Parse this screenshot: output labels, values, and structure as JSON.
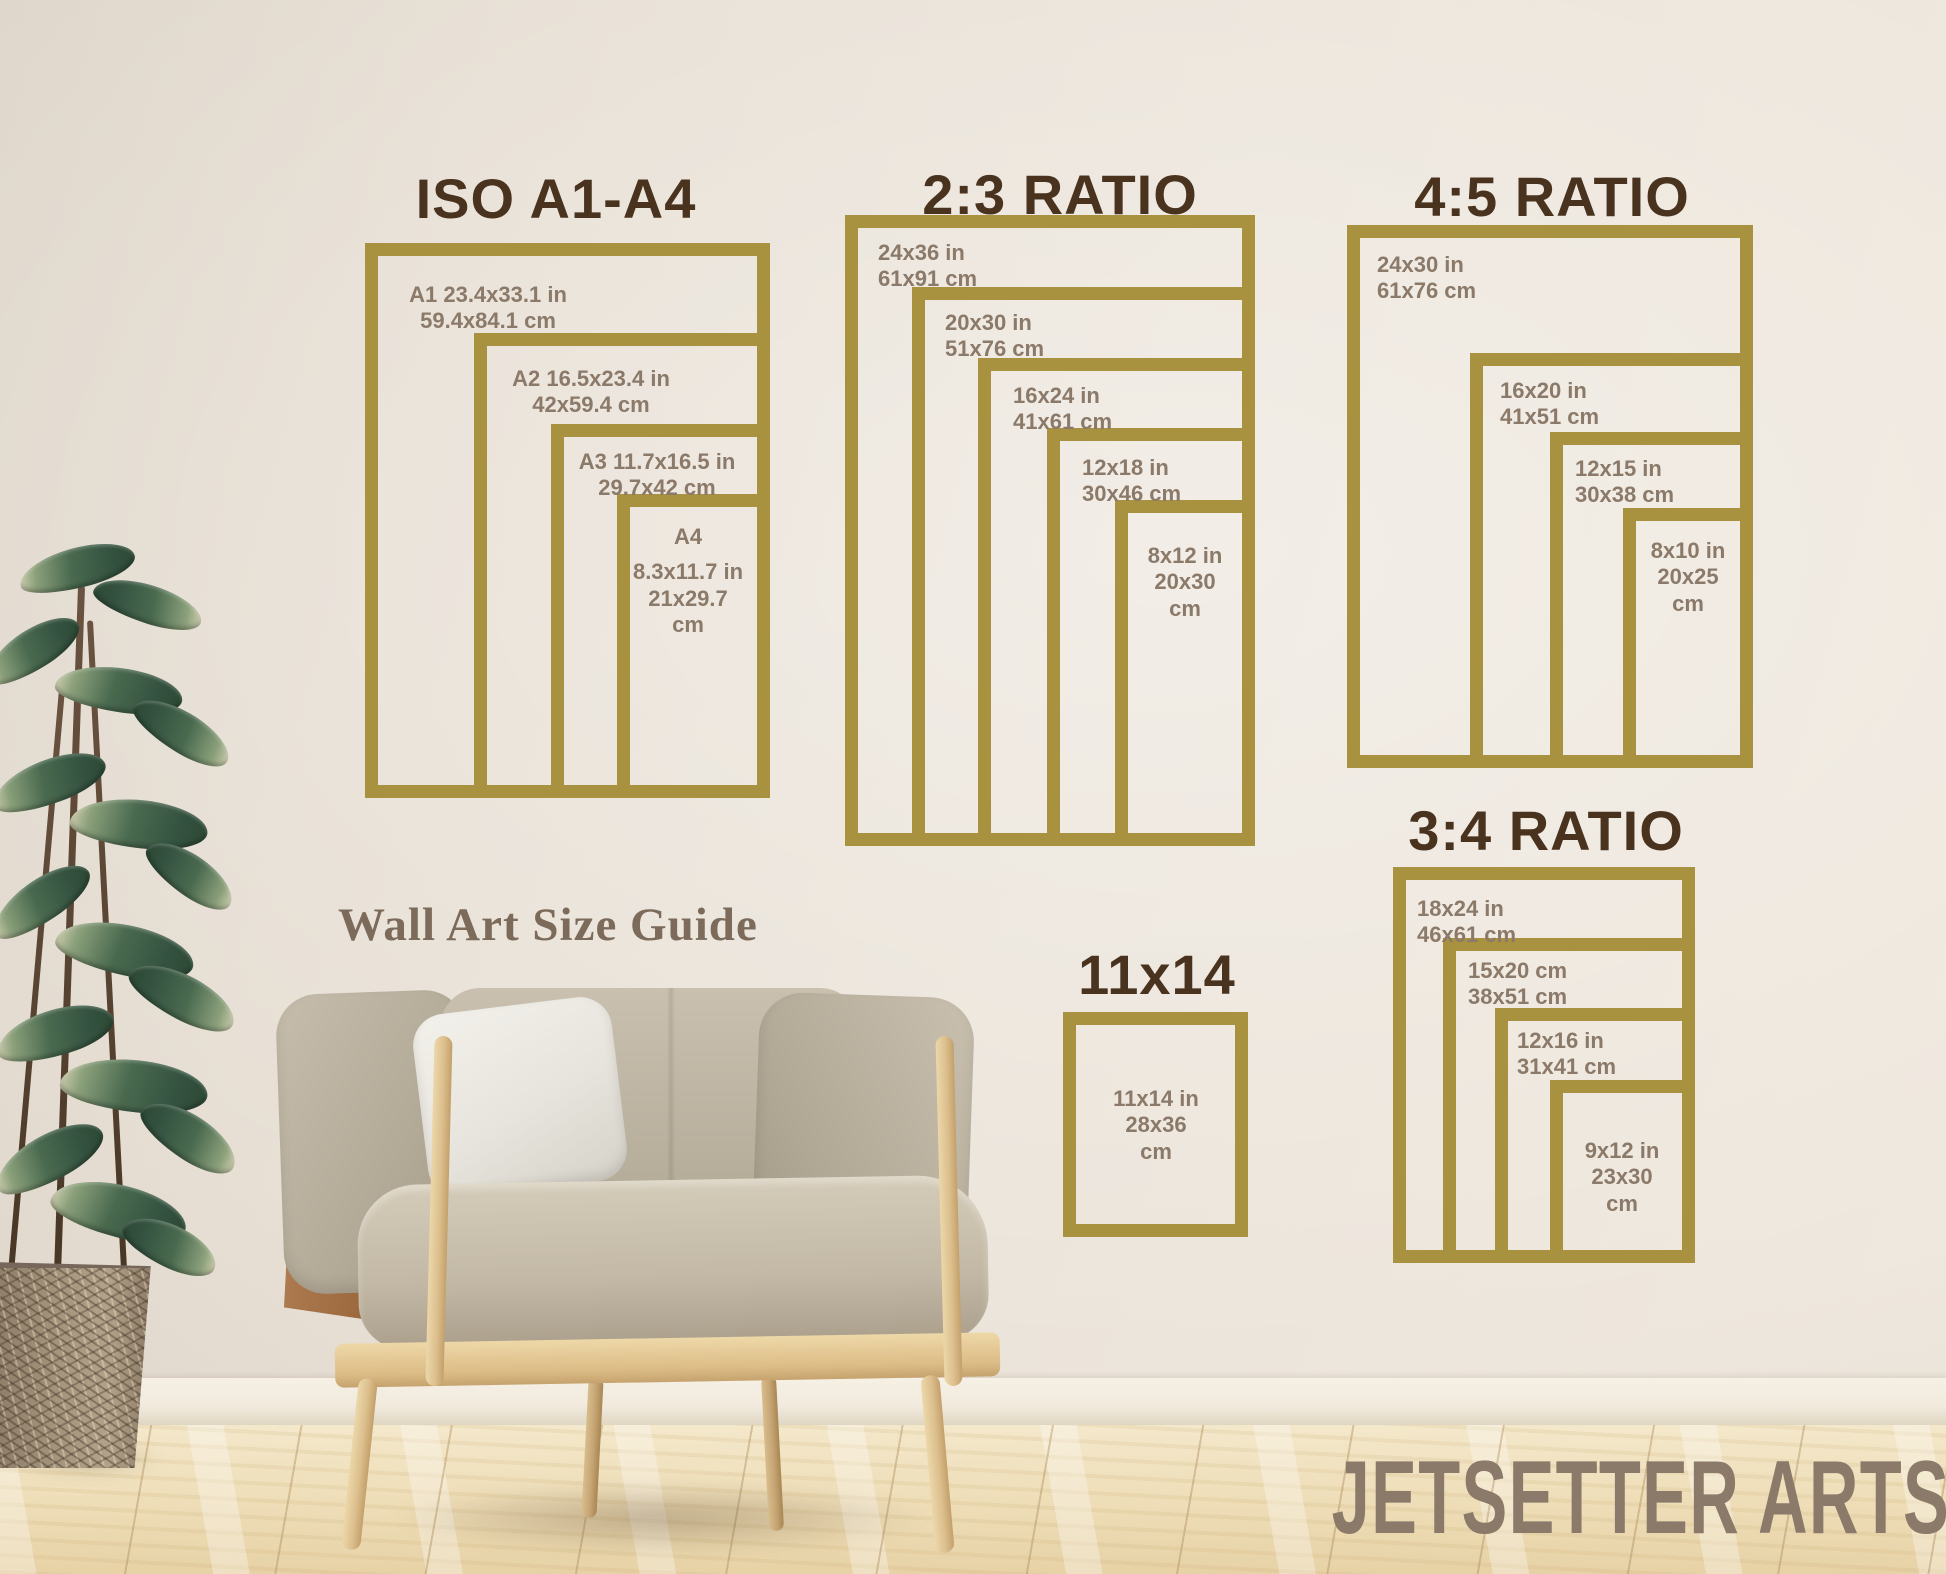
{
  "guide_title": "Wall Art Size Guide",
  "brand": "JETSETTER ARTS",
  "colors": {
    "frame_gold": "#a8913f",
    "title_brown": "#49331f",
    "label_taupe": "#8b7a69",
    "wall_cream": "#ebe4da",
    "floor_wood": "#efdfba"
  },
  "sections": {
    "iso": {
      "title": "ISO A1-A4",
      "frames": [
        {
          "l1": "A1 23.4x33.1 in",
          "l2": "59.4x84.1 cm"
        },
        {
          "l1": "A2 16.5x23.4 in",
          "l2": "42x59.4 cm"
        },
        {
          "l1": "A3 11.7x16.5 in",
          "l2": "29.7x42 cm"
        },
        {
          "l1": "A4",
          "l2": "8.3x11.7 in",
          "l3": "21x29.7",
          "l4": "cm"
        }
      ]
    },
    "ratio23": {
      "title": "2:3 RATIO",
      "frames": [
        {
          "l1": "24x36 in",
          "l2": "61x91 cm"
        },
        {
          "l1": "20x30 in",
          "l2": "51x76 cm"
        },
        {
          "l1": "16x24 in",
          "l2": "41x61 cm"
        },
        {
          "l1": "12x18 in",
          "l2": "30x46 cm"
        },
        {
          "l1": "8x12 in",
          "l2": "20x30",
          "l3": "cm"
        }
      ]
    },
    "ratio45": {
      "title": "4:5 RATIO",
      "frames": [
        {
          "l1": "24x30 in",
          "l2": "61x76 cm"
        },
        {
          "l1": "16x20 in",
          "l2": "41x51 cm"
        },
        {
          "l1": "12x15 in",
          "l2": "30x38 cm"
        },
        {
          "l1": "8x10 in",
          "l2": "20x25",
          "l3": "cm"
        }
      ]
    },
    "ratio34": {
      "title": "3:4 RATIO",
      "frames": [
        {
          "l1": "18x24 in",
          "l2": "46x61 cm"
        },
        {
          "l1": "15x20 cm",
          "l2": "38x51 cm"
        },
        {
          "l1": "12x16 in",
          "l2": "31x41 cm"
        },
        {
          "l1": "9x12 in",
          "l2": "23x30",
          "l3": "cm"
        }
      ]
    },
    "single1114": {
      "title": "11x14",
      "frames": [
        {
          "l1": "11x14 in",
          "l2": "28x36",
          "l3": "cm"
        }
      ]
    }
  }
}
